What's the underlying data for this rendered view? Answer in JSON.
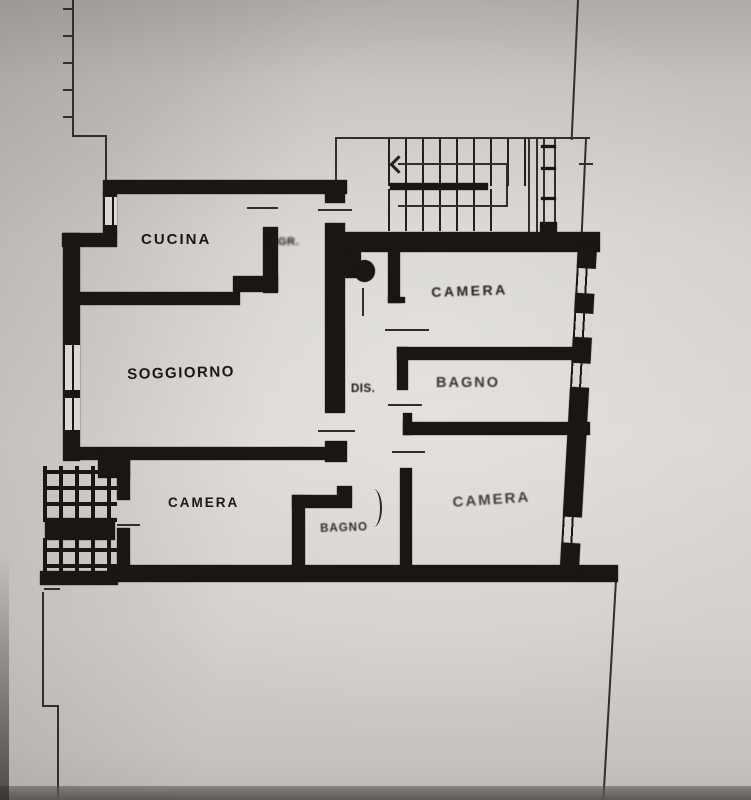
{
  "rooms": {
    "kitchen": {
      "label": "CUCINA"
    },
    "entry": {
      "label": "INGR."
    },
    "living": {
      "label": "SOGGIORNO"
    },
    "hallway": {
      "label": "DIS."
    },
    "bedroom_north": {
      "label": "CAMERA"
    },
    "bathroom_main": {
      "label": "BAGNO"
    },
    "bedroom_southeast": {
      "label": "CAMERA"
    },
    "bedroom_southwest": {
      "label": "CAMERA"
    },
    "bathroom_small": {
      "label": "BAGNO"
    }
  },
  "colors": {
    "ink": "#1a1612",
    "paper": "#d9d5d1"
  }
}
